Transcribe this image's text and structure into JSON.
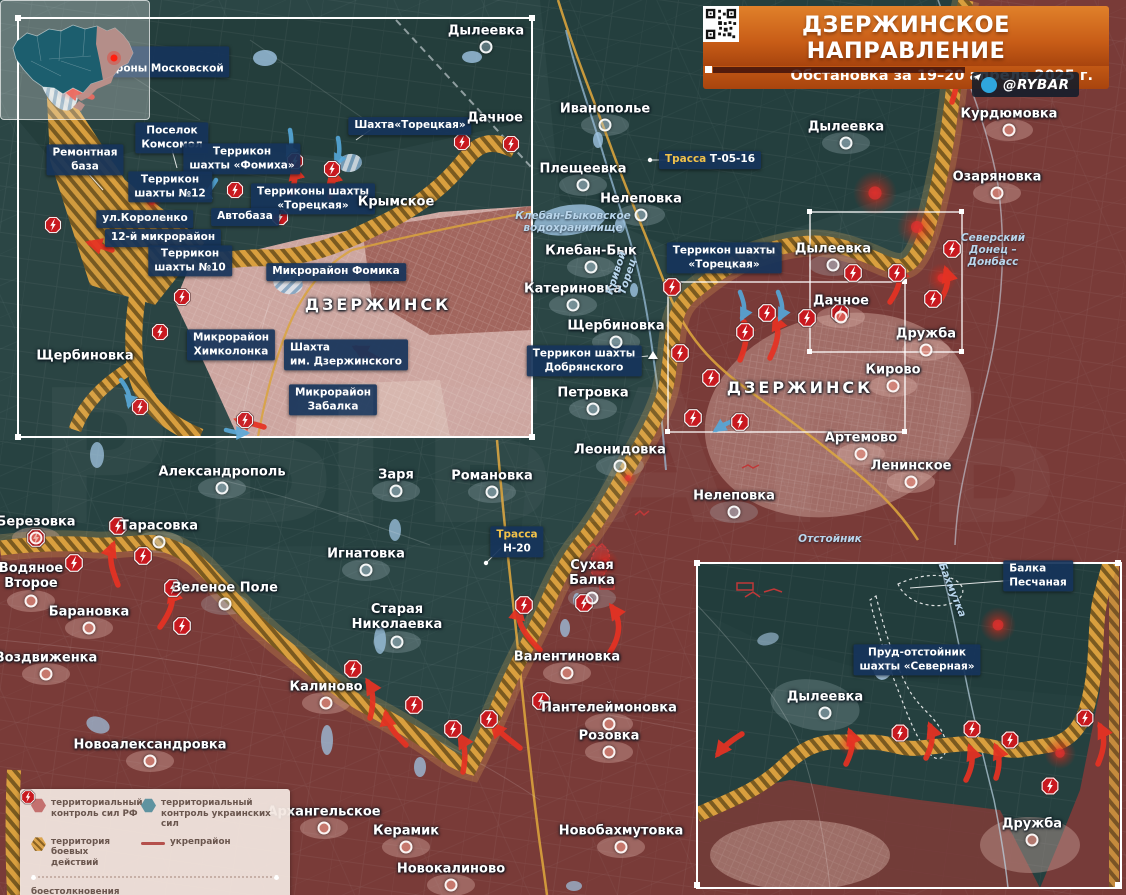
{
  "header": {
    "title": "ДЗЕРЖИНСКОЕ НАПРАВЛЕНИЕ",
    "subtitle": "Обстановка за 19–20 апреля 2025 г.",
    "credit": "@RYBAR"
  },
  "watermark": {
    "text": "РЫБАРЬ"
  },
  "legend": {
    "items": [
      {
        "icon": "hex-rf",
        "label": "территориальный контроль сил РФ"
      },
      {
        "icon": "hex-ua",
        "label": "территориальный контроль украинских сил"
      },
      {
        "icon": "hex-combat",
        "label": "территория боевых действий"
      },
      {
        "icon": "line-fort",
        "label": "укрепрайон"
      },
      {
        "icon": "clash",
        "label": "боестолкновения"
      }
    ]
  },
  "colors": {
    "rf_zone": "#7d3b38",
    "ua_zone": "#2b4645",
    "combat_hatch": "#d99f3e",
    "label_box": "#16345a",
    "accent_orange": "#c85d17",
    "clash_red": "#c8191f",
    "arrow_red": "#e63223",
    "arrow_blue": "#55a8da",
    "water": "#9fc4e2",
    "road_gold": "#d9a33c"
  },
  "labels": {
    "main": [
      {
        "t": "Иванополье",
        "x": 605,
        "y": 110,
        "k": "town"
      },
      {
        "t": "Плещеевка",
        "x": 583,
        "y": 170,
        "k": "town"
      },
      {
        "t": "Нелеповка",
        "x": 641,
        "y": 200,
        "k": "town"
      },
      {
        "t": "Клебан-Бык",
        "x": 591,
        "y": 252,
        "k": "town"
      },
      {
        "t": "Катериновка",
        "x": 573,
        "y": 290,
        "k": "town"
      },
      {
        "t": "Щербиновка",
        "x": 616,
        "y": 327,
        "k": "town"
      },
      {
        "t": "Петровка",
        "x": 593,
        "y": 394,
        "k": "town"
      },
      {
        "t": "Леонидовка",
        "x": 620,
        "y": 451,
        "k": "town"
      },
      {
        "t": "Нелеповка",
        "x": 734,
        "y": 497,
        "k": "town"
      },
      {
        "t": "Дылеевка",
        "x": 846,
        "y": 128,
        "k": "town"
      },
      {
        "t": "Дылеевка",
        "x": 833,
        "y": 250,
        "k": "town"
      },
      {
        "t": "Александрополь",
        "x": 222,
        "y": 473,
        "k": "town"
      },
      {
        "t": "Тарасовка",
        "x": 159,
        "y": 527,
        "k": "town"
      },
      {
        "t": "Зеленое Поле",
        "x": 225,
        "y": 589,
        "k": "town"
      },
      {
        "t": "Заря",
        "x": 396,
        "y": 476,
        "k": "town"
      },
      {
        "t": "Романовка",
        "x": 492,
        "y": 477,
        "k": "town"
      },
      {
        "t": "Игнатовка",
        "x": 366,
        "y": 555,
        "k": "town"
      },
      {
        "t": "Старая\nНиколаевка",
        "x": 397,
        "y": 618,
        "k": "town"
      },
      {
        "t": "Сухая\nБалка",
        "x": 592,
        "y": 574,
        "k": "town"
      },
      {
        "t": "Березовка",
        "x": 36,
        "y": 523,
        "k": "town-r"
      },
      {
        "t": "Водяное\nВторое",
        "x": 31,
        "y": 577,
        "k": "town-r"
      },
      {
        "t": "Барановка",
        "x": 89,
        "y": 613,
        "k": "town-r"
      },
      {
        "t": "Воздвиженка",
        "x": 46,
        "y": 659,
        "k": "town-r"
      },
      {
        "t": "Курдюмовка",
        "x": 1009,
        "y": 115,
        "k": "town-r"
      },
      {
        "t": "Озаряновка",
        "x": 997,
        "y": 178,
        "k": "town-r"
      },
      {
        "t": "Дачное",
        "x": 841,
        "y": 302,
        "k": "town-r"
      },
      {
        "t": "Дружба",
        "x": 926,
        "y": 335,
        "k": "town-r"
      },
      {
        "t": "Кирово",
        "x": 893,
        "y": 371,
        "k": "town-r"
      },
      {
        "t": "Артемово",
        "x": 861,
        "y": 439,
        "k": "town-r"
      },
      {
        "t": "Ленинское",
        "x": 911,
        "y": 467,
        "k": "town-r"
      },
      {
        "t": "Валентиновка",
        "x": 567,
        "y": 658,
        "k": "town-r"
      },
      {
        "t": "Калиново",
        "x": 326,
        "y": 688,
        "k": "town-r"
      },
      {
        "t": "Пантелеймоновка",
        "x": 609,
        "y": 709,
        "k": "town-r"
      },
      {
        "t": "Розовка",
        "x": 609,
        "y": 737,
        "k": "town-r"
      },
      {
        "t": "Новоалександровка",
        "x": 150,
        "y": 746,
        "k": "town-r"
      },
      {
        "t": "Архангельское",
        "x": 324,
        "y": 813,
        "k": "town-r"
      },
      {
        "t": "Керамик",
        "x": 406,
        "y": 832,
        "k": "town-r"
      },
      {
        "t": "Новокалиново",
        "x": 451,
        "y": 870,
        "k": "town-r"
      },
      {
        "t": "Новобахмутовка",
        "x": 621,
        "y": 832,
        "k": "town-r"
      },
      {
        "t": "ДЗЕРЖИНСК",
        "x": 800,
        "y": 388,
        "k": "city"
      },
      {
        "t": "Клебан-Быковское\nводохранилище",
        "x": 573,
        "y": 222,
        "k": "water"
      },
      {
        "t": "Кривой\nТорец",
        "x": 622,
        "y": 275,
        "k": "water",
        "rot": -72
      },
      {
        "t": "Северский\nДонец –\nДонбасс",
        "x": 993,
        "y": 250,
        "k": "water"
      },
      {
        "t": "Отстойник",
        "x": 830,
        "y": 539,
        "k": "water"
      },
      {
        "t": "Террикон шахты\n«Торецкая»",
        "x": 724,
        "y": 258,
        "k": "box"
      },
      {
        "t": "Террикон шахты\nДобрянского",
        "x": 584,
        "y": 361,
        "k": "box"
      },
      {
        "pre": "Трасса",
        "t": "Т-05-16",
        "x": 710,
        "y": 160,
        "k": "road"
      },
      {
        "pre": "Трасса",
        "t": "Н-20",
        "x": 517,
        "y": 542,
        "k": "road2"
      }
    ],
    "inset_tl": [
      {
        "t": "Шахта имени\nсвятой Матроны Московской",
        "x": 136,
        "y": 62,
        "k": "box",
        "align": "left"
      },
      {
        "t": "Ремонтная\nбаза",
        "x": 85,
        "y": 160,
        "k": "box"
      },
      {
        "t": "Поселок\nКомсомол",
        "x": 172,
        "y": 138,
        "k": "box"
      },
      {
        "t": "Террикон\nшахты «Фомиха»",
        "x": 242,
        "y": 159,
        "k": "box"
      },
      {
        "t": "Террикон\nшахты №12",
        "x": 170,
        "y": 187,
        "k": "box"
      },
      {
        "t": "Терриконы шахты\n«Торецкая»",
        "x": 313,
        "y": 199,
        "k": "box"
      },
      {
        "t": "ул.Короленко",
        "x": 145,
        "y": 219,
        "k": "box"
      },
      {
        "t": "Автобаза",
        "x": 245,
        "y": 217,
        "k": "box"
      },
      {
        "t": "12-й микрорайон",
        "x": 163,
        "y": 238,
        "k": "box"
      },
      {
        "t": "Террикон\nшахты №10",
        "x": 190,
        "y": 261,
        "k": "box"
      },
      {
        "t": "Микрорайон Фомика",
        "x": 336,
        "y": 272,
        "k": "box"
      },
      {
        "t": "Микрорайон\nХимколонка",
        "x": 231,
        "y": 345,
        "k": "box"
      },
      {
        "t": "Шахта\nим. Дзержинского",
        "x": 346,
        "y": 355,
        "k": "box",
        "align": "left"
      },
      {
        "t": "Микрорайон\nЗабалка",
        "x": 333,
        "y": 400,
        "k": "box"
      },
      {
        "t": "Шахта«Торецкая»",
        "x": 410,
        "y": 126,
        "k": "box"
      },
      {
        "t": "Щербиновка",
        "x": 85,
        "y": 357,
        "k": "town",
        "nodot": 1
      },
      {
        "t": "Крымское",
        "x": 396,
        "y": 203,
        "k": "town",
        "nodot": 1
      },
      {
        "t": "Дылеевка",
        "x": 486,
        "y": 32,
        "k": "town"
      },
      {
        "t": "Дачное",
        "x": 495,
        "y": 119,
        "k": "town",
        "nodot": 1
      },
      {
        "t": "ДЗЕРЖИНСК",
        "x": 378,
        "y": 305,
        "k": "city"
      }
    ],
    "inset_br": [
      {
        "t": "Балка\nПесчаная",
        "x": 1038,
        "y": 576,
        "k": "box",
        "align": "left"
      },
      {
        "t": "Пруд-отстойник\nшахты «Северная»",
        "x": 917,
        "y": 660,
        "k": "box"
      },
      {
        "t": "Дылеевка",
        "x": 825,
        "y": 698,
        "k": "town"
      },
      {
        "t": "Дружба",
        "x": 1032,
        "y": 825,
        "k": "town-r"
      },
      {
        "t": "Бахмутка",
        "x": 952,
        "y": 590,
        "k": "water",
        "rot": 68
      }
    ]
  },
  "markers": {
    "clash_main": [
      [
        36,
        538
      ],
      [
        74,
        563
      ],
      [
        118,
        526
      ],
      [
        143,
        556
      ],
      [
        173,
        588
      ],
      [
        182,
        626
      ],
      [
        353,
        669
      ],
      [
        414,
        705
      ],
      [
        453,
        729
      ],
      [
        489,
        719
      ],
      [
        541,
        701
      ],
      [
        524,
        605
      ],
      [
        584,
        603
      ],
      [
        672,
        287
      ],
      [
        745,
        332
      ],
      [
        680,
        353
      ],
      [
        711,
        378
      ],
      [
        693,
        418
      ],
      [
        740,
        422
      ],
      [
        767,
        313
      ],
      [
        807,
        318
      ],
      [
        840,
        313
      ],
      [
        853,
        273
      ],
      [
        897,
        273
      ],
      [
        933,
        299
      ],
      [
        952,
        249
      ]
    ],
    "clash_tl": [
      [
        65,
        74
      ],
      [
        53,
        225
      ],
      [
        235,
        190
      ],
      [
        295,
        161
      ],
      [
        332,
        169
      ],
      [
        280,
        217
      ],
      [
        182,
        297
      ],
      [
        160,
        332
      ],
      [
        140,
        407
      ],
      [
        245,
        420
      ],
      [
        462,
        142
      ],
      [
        511,
        144
      ]
    ],
    "clash_br": [
      [
        900,
        733
      ],
      [
        972,
        729
      ],
      [
        1010,
        740
      ],
      [
        1050,
        786
      ],
      [
        1085,
        718
      ]
    ],
    "triangles": [
      [
        653,
        355
      ]
    ]
  },
  "arrows": {
    "red": [
      "M118,585 C112,570 108,558 113,545",
      "M160,627 C170,613 175,601 171,590",
      "M540,650 C526,636 516,623 519,608",
      "M610,652 C620,637 622,621 612,607",
      "M370,718 C374,704 374,692 368,682",
      "M406,745 C396,735 388,726 386,714",
      "M463,772 C466,758 466,746 460,736",
      "M520,748 C509,739 500,733 493,725",
      "M770,358 C778,342 780,330 775,318",
      "M740,360 C746,346 748,334 744,322",
      "M890,302 C898,290 902,280 898,268",
      "M938,304 C946,292 950,282 946,270",
      "M952,102 C958,84 960,70 954,54",
      "M92,97 C82,94 74,92 66,90",
      "M292,194 C294,184 296,176 294,168",
      "M330,197 C332,187 334,179 332,171",
      "M112,250 C104,247 97,245 90,243",
      "M264,427 C254,424 246,422 238,420",
      "M382,362 C372,356 364,352 356,348",
      "M846,764 C852,752 854,742 850,732",
      "M926,758 C932,746 934,736 930,726",
      "M966,780 C972,768 974,758 970,748",
      "M996,778 C1000,766 1000,756 996,747",
      "M1098,764 C1104,750 1106,738 1100,726",
      "M742,734 C732,740 724,746 718,754"
    ],
    "blue": [
      "M740,292 C744,302 746,310 742,318",
      "M778,292 C782,302 784,310 780,318",
      "M736,420 C728,422 722,426 716,430",
      "M290,130 C292,140 292,148 288,156",
      "M338,138 C340,148 340,156 336,164",
      "M216,180 C211,188 207,194 201,198",
      "M121,380 C127,388 131,396 129,405",
      "M226,430 C233,432 239,433 246,433"
    ]
  },
  "glows": [
    [
      875,
      193,
      22
    ],
    [
      917,
      227,
      20
    ],
    [
      942,
      278,
      15
    ],
    [
      605,
      563,
      14
    ],
    [
      628,
      478,
      9
    ],
    [
      998,
      625,
      18
    ],
    [
      1060,
      753,
      16
    ],
    [
      850,
      744,
      12
    ],
    [
      70,
      88,
      13
    ],
    [
      152,
      202,
      9
    ]
  ],
  "leaders": [
    {
      "d": "M84,72 L68,90"
    },
    {
      "d": "M679,160 L652,160",
      "dot": [
        650,
        160
      ]
    },
    {
      "d": "M501,548 L487,562",
      "dot": [
        486,
        563
      ]
    },
    {
      "d": "M1016,580 L910,588"
    },
    {
      "d": "M373,128 L356,140"
    },
    {
      "d": "M628,358 L648,356"
    },
    {
      "d": "M85,170 L103,190"
    },
    {
      "d": "M172,150 L177,168"
    }
  ],
  "forts": [
    "M588,548 l5,-4 4,4 5,-4 4,4",
    "M635,515 l5,-4 4,4 5,-4",
    "M742,468 l6,-3 5,3 6,-3",
    "M600,583 h14 v6 h-14 z",
    "M737,583 h16 v7 h-16 z",
    "M764,592 l10,-3 8,3",
    "M745,597 l8,-5 7,5"
  ]
}
